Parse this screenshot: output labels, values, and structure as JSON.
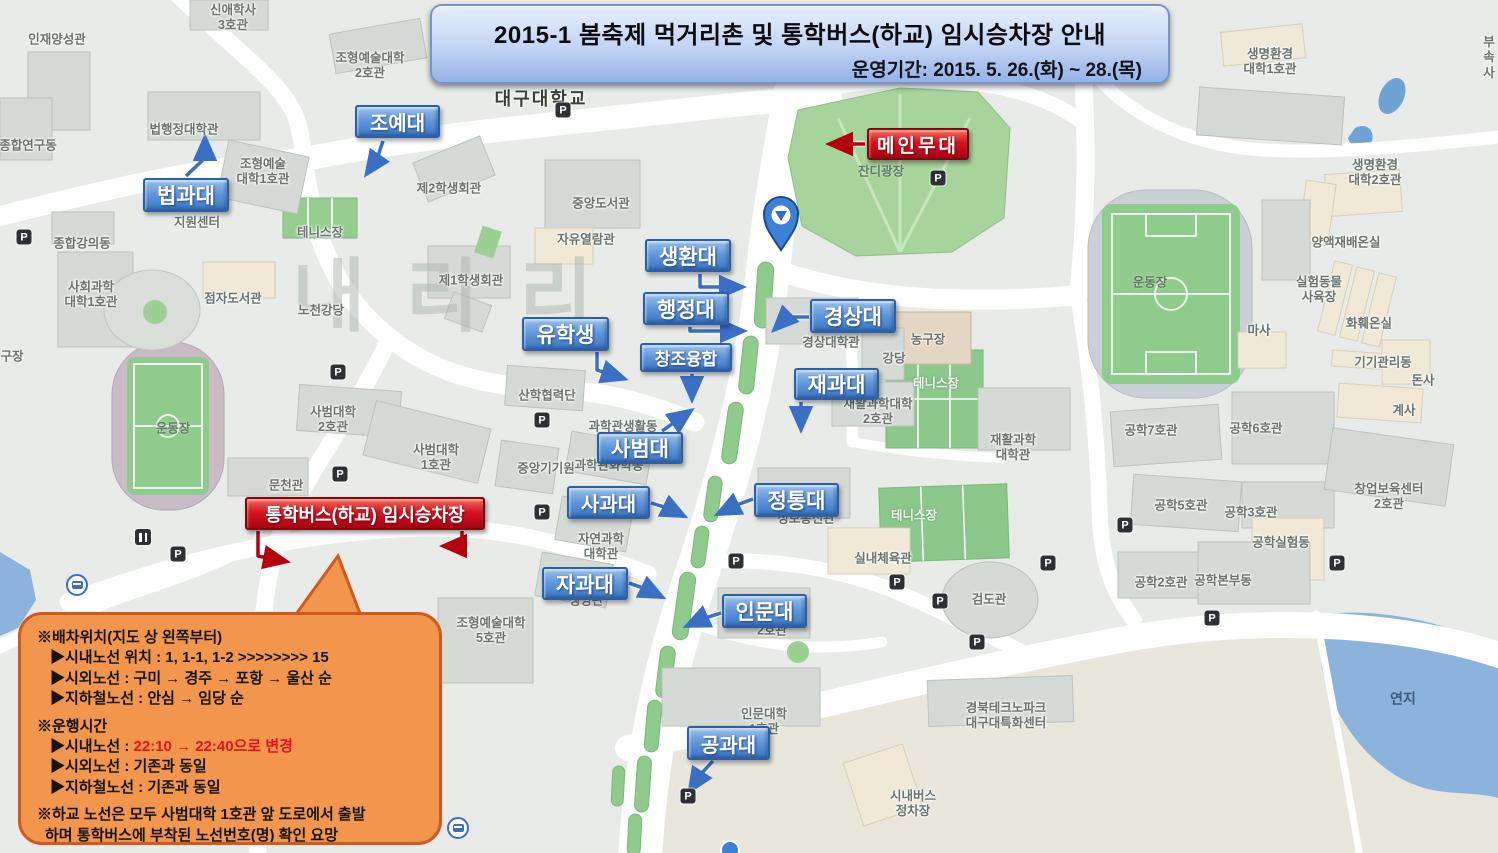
{
  "banner": {
    "title": "2015-1 봄축제 먹거리촌 및 통학버스(하교) 임시승차장 안내",
    "subtitle": "운영기간: 2015. 5. 26.(화) ~ 28.(목)"
  },
  "stage_label": {
    "text": "메인무대",
    "arrow": [
      [
        865,
        144
      ],
      [
        832,
        144
      ]
    ]
  },
  "bus_label": {
    "text": "통학버스(하교) 임시승차장",
    "arrows": [
      [
        [
          258,
          531
        ],
        [
          258,
          556
        ],
        [
          284,
          561
        ]
      ],
      [
        [
          462,
          531
        ],
        [
          462,
          546
        ],
        [
          446,
          546
        ]
      ]
    ]
  },
  "college_labels": [
    {
      "text": "조예대",
      "x": 355,
      "y": 105,
      "w": 85,
      "h": 33,
      "fs": 20,
      "arrow": [
        [
          383,
          141
        ],
        [
          377,
          159
        ],
        [
          368,
          172
        ]
      ]
    },
    {
      "text": "법과대",
      "x": 143,
      "y": 178,
      "w": 86,
      "h": 34,
      "fs": 21,
      "arrow": [
        [
          186,
          176
        ],
        [
          205,
          158
        ],
        [
          205,
          140
        ]
      ]
    },
    {
      "text": "생환대",
      "x": 645,
      "y": 239,
      "w": 86,
      "h": 33,
      "fs": 21,
      "arrow": [
        [
          700,
          274
        ],
        [
          700,
          287
        ],
        [
          740,
          287
        ]
      ]
    },
    {
      "text": "행정대",
      "x": 643,
      "y": 292,
      "w": 86,
      "h": 33,
      "fs": 21,
      "arrow": [
        [
          690,
          327
        ],
        [
          690,
          331
        ],
        [
          741,
          331
        ]
      ]
    },
    {
      "text": "유학생",
      "x": 522,
      "y": 317,
      "w": 87,
      "h": 34,
      "fs": 21,
      "arrow": [
        [
          597,
          352
        ],
        [
          597,
          370
        ],
        [
          622,
          378
        ]
      ]
    },
    {
      "text": "창조융합",
      "x": 640,
      "y": 343,
      "w": 92,
      "h": 29,
      "fs": 17,
      "arrow": [
        [
          692,
          374
        ],
        [
          692,
          397
        ]
      ]
    },
    {
      "text": "경상대",
      "x": 810,
      "y": 299,
      "w": 86,
      "h": 34,
      "fs": 21,
      "arrow": [
        [
          809,
          317
        ],
        [
          787,
          317
        ],
        [
          776,
          328
        ]
      ]
    },
    {
      "text": "재과대",
      "x": 794,
      "y": 368,
      "w": 85,
      "h": 32,
      "fs": 21,
      "arrow": [
        [
          801,
          402
        ],
        [
          801,
          427
        ]
      ]
    },
    {
      "text": "사범대",
      "x": 597,
      "y": 432,
      "w": 86,
      "h": 32,
      "fs": 21,
      "arrow": [
        [
          662,
          431
        ],
        [
          689,
          412
        ]
      ]
    },
    {
      "text": "사과대",
      "x": 567,
      "y": 486,
      "w": 83,
      "h": 33,
      "fs": 20,
      "arrow": [
        [
          651,
          503
        ],
        [
          668,
          508
        ],
        [
          682,
          515
        ]
      ]
    },
    {
      "text": "정통대",
      "x": 754,
      "y": 483,
      "w": 85,
      "h": 34,
      "fs": 21,
      "arrow": [
        [
          753,
          499
        ],
        [
          734,
          506
        ],
        [
          720,
          513
        ]
      ]
    },
    {
      "text": "자과대",
      "x": 542,
      "y": 567,
      "w": 86,
      "h": 33,
      "fs": 21,
      "arrow": [
        [
          629,
          583
        ],
        [
          646,
          589
        ],
        [
          660,
          596
        ]
      ]
    },
    {
      "text": "인문대",
      "x": 722,
      "y": 594,
      "w": 85,
      "h": 34,
      "fs": 21,
      "arrow": [
        [
          721,
          613
        ],
        [
          702,
          619
        ],
        [
          689,
          625
        ]
      ]
    },
    {
      "text": "공과대",
      "x": 687,
      "y": 726,
      "w": 83,
      "h": 34,
      "fs": 20,
      "arrow": [
        [
          713,
          761
        ],
        [
          700,
          775
        ],
        [
          691,
          789
        ]
      ]
    }
  ],
  "notice": {
    "s1_title": "※배차위치(지도 상 왼쪽부터)",
    "s1_items": [
      "▶시내노선 위치 : 1, 1-1, 1-2 >>>>>>>> 15",
      "▶시외노선 : 구미 → 경주 → 포항 → 울산 순",
      "▶지하철노선 : 안심 → 임당 순"
    ],
    "s2_title": "※운행시간",
    "s2_item1_prefix": "▶시내노선 : ",
    "s2_item1_highlight": "22:10 → 22:40으로 변경",
    "s2_items_rest": [
      "▶시외노선 : 기존과 동일",
      "▶지하철노선 : 기존과 동일"
    ],
    "s3_lines": [
      "※하교 노선은 모두 사범대학 1호관 앞 도로에서 출발",
      "하며 통학버스에 부착된 노선번호(명) 확인 요망"
    ]
  },
  "watermark": "내리리",
  "map_labels": [
    {
      "t": "신애학사\n3호관",
      "x": 233,
      "y": 18
    },
    {
      "t": "인재양성관",
      "x": 57,
      "y": 40
    },
    {
      "t": "조형예술대학\n2호관",
      "x": 370,
      "y": 66
    },
    {
      "t": "대구대학교",
      "x": 541,
      "y": 100,
      "cls": "big"
    },
    {
      "t": "법행정대학관",
      "x": 184,
      "y": 130
    },
    {
      "t": "종합연구동",
      "x": 28,
      "y": 146
    },
    {
      "t": "조형예술\n대학1호관",
      "x": 263,
      "y": 172
    },
    {
      "t": "지원센터",
      "x": 197,
      "y": 223
    },
    {
      "t": "테니스장",
      "x": 320,
      "y": 233
    },
    {
      "t": "제2학생회관",
      "x": 449,
      "y": 189
    },
    {
      "t": "중앙도서관",
      "x": 601,
      "y": 204
    },
    {
      "t": "자유열람관",
      "x": 586,
      "y": 240
    },
    {
      "t": "잔디광장",
      "x": 881,
      "y": 172,
      "cls": "ongreen"
    },
    {
      "t": "종합강의동",
      "x": 82,
      "y": 244
    },
    {
      "t": "사회과학\n대학1호관",
      "x": 91,
      "y": 295
    },
    {
      "t": "점자도서관",
      "x": 233,
      "y": 299
    },
    {
      "t": "노천강당",
      "x": 321,
      "y": 311
    },
    {
      "t": "제1학생회관",
      "x": 471,
      "y": 281
    },
    {
      "t": "생명환경\n대학1호관",
      "x": 1270,
      "y": 62
    },
    {
      "t": "생명환경\n대학2호관",
      "x": 1375,
      "y": 173
    },
    {
      "t": "부속\n사",
      "x": 1489,
      "y": 58
    },
    {
      "t": "운동장",
      "x": 1150,
      "y": 283,
      "cls": "ongreen"
    },
    {
      "t": "양액재배온실",
      "x": 1346,
      "y": 243
    },
    {
      "t": "실험동물\n사육장",
      "x": 1319,
      "y": 290
    },
    {
      "t": "마사",
      "x": 1259,
      "y": 331
    },
    {
      "t": "화훼온실",
      "x": 1369,
      "y": 324
    },
    {
      "t": "기기관리동",
      "x": 1383,
      "y": 363
    },
    {
      "t": "돈사",
      "x": 1423,
      "y": 381
    },
    {
      "t": "계사",
      "x": 1404,
      "y": 411
    },
    {
      "t": "공학7호관",
      "x": 1151,
      "y": 431
    },
    {
      "t": "공학6호관",
      "x": 1256,
      "y": 429
    },
    {
      "t": "공학5호관",
      "x": 1181,
      "y": 506
    },
    {
      "t": "공학3호관",
      "x": 1251,
      "y": 513
    },
    {
      "t": "창업보육센터\n2호관",
      "x": 1389,
      "y": 497
    },
    {
      "t": "공학실험동",
      "x": 1281,
      "y": 543
    },
    {
      "t": "공학2호관",
      "x": 1161,
      "y": 583
    },
    {
      "t": "공학본부동",
      "x": 1223,
      "y": 581
    },
    {
      "t": "재활과학\n대학관",
      "x": 1013,
      "y": 448
    },
    {
      "t": "재활과학대학\n2호관",
      "x": 878,
      "y": 412
    },
    {
      "t": "경상대학관",
      "x": 831,
      "y": 343
    },
    {
      "t": "강당",
      "x": 894,
      "y": 359
    },
    {
      "t": "농구장",
      "x": 928,
      "y": 340
    },
    {
      "t": "테니스장",
      "x": 936,
      "y": 384,
      "cls": "white"
    },
    {
      "t": "테니스장",
      "x": 914,
      "y": 516,
      "cls": "white"
    },
    {
      "t": "사범대학\n2호관",
      "x": 333,
      "y": 420
    },
    {
      "t": "사범대학\n1호관",
      "x": 436,
      "y": 458
    },
    {
      "t": "산학협력단",
      "x": 547,
      "y": 396
    },
    {
      "t": "중앙기기원",
      "x": 546,
      "y": 469
    },
    {
      "t": "과학관화학동",
      "x": 609,
      "y": 466
    },
    {
      "t": "과학관생활동",
      "x": 623,
      "y": 427
    },
    {
      "t": "문천관",
      "x": 286,
      "y": 486
    },
    {
      "t": "운동장",
      "x": 173,
      "y": 429,
      "cls": "ongreen"
    },
    {
      "t": "구장",
      "x": 12,
      "y": 357
    },
    {
      "t": "자연과학\n대학관",
      "x": 601,
      "y": 547
    },
    {
      "t": "생명관",
      "x": 586,
      "y": 601
    },
    {
      "t": "조형예술대학\n5호관",
      "x": 491,
      "y": 631
    },
    {
      "t": "정보통신관",
      "x": 806,
      "y": 519
    },
    {
      "t": "실내체육관",
      "x": 883,
      "y": 559
    },
    {
      "t": "검도관",
      "x": 989,
      "y": 600
    },
    {
      "t": "2호관",
      "x": 772,
      "y": 631
    },
    {
      "t": "인문대학\n1호관",
      "x": 764,
      "y": 722
    },
    {
      "t": "경북테크노파크\n대구대특화센터",
      "x": 1006,
      "y": 716
    },
    {
      "t": "시내버스\n정차장",
      "x": 913,
      "y": 804
    },
    {
      "t": "연지",
      "x": 1403,
      "y": 699,
      "cls": "water"
    }
  ],
  "icons": {
    "parking_glyph": "P",
    "parking": [
      [
        563,
        110
      ],
      [
        938,
        178
      ],
      [
        24,
        237
      ],
      [
        338,
        372
      ],
      [
        542,
        420
      ],
      [
        340,
        474
      ],
      [
        542,
        512
      ],
      [
        736,
        561
      ],
      [
        897,
        582
      ],
      [
        940,
        601
      ],
      [
        977,
        642
      ],
      [
        1048,
        563
      ],
      [
        1125,
        525
      ],
      [
        1212,
        618
      ],
      [
        1337,
        563
      ],
      [
        178,
        554
      ],
      [
        688,
        796
      ]
    ],
    "bus_stops": [
      [
        77,
        585
      ],
      [
        458,
        828
      ]
    ],
    "restaurant": [
      143,
      537
    ],
    "map_pin": [
      781,
      222
    ]
  },
  "colors": {
    "label_blue": "#3b77c4",
    "label_red": "#c00a1c",
    "bubble_orange": "#f2964e",
    "bubble_border": "#d2591d",
    "grass": "#a6d49c",
    "field_green": "#8ecb8d",
    "water": "#8cb3dc",
    "road": "#ffffff",
    "arrow_blue": "#3a6fc4",
    "arrow_red": "#b50010"
  }
}
